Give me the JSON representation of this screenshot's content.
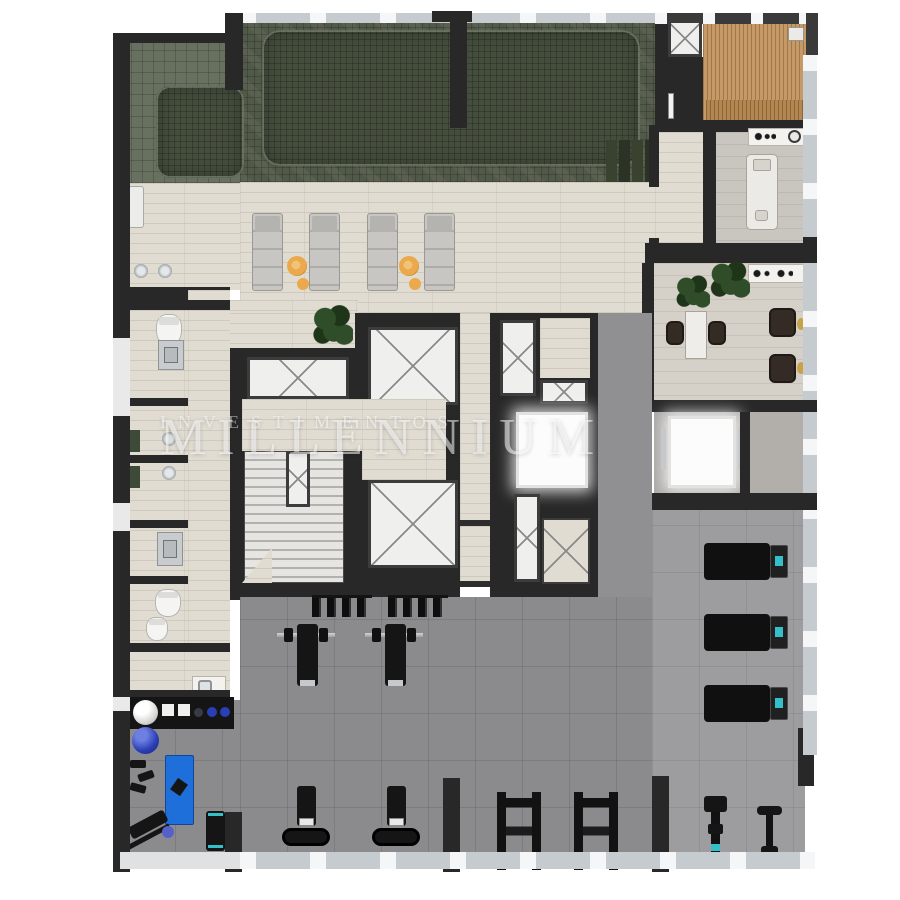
{
  "watermark": {
    "line1": "MILLENNIUM",
    "line2": "INVESTIMENTOS"
  },
  "palette": {
    "wall": "#282828",
    "wall-soft": "#3a3a3a",
    "pool-terrace": "#68705f",
    "pool-base": "#515948",
    "pool-water": "#454e3d",
    "trav": "#e1dcd2",
    "room-floor": "#c9c5bf",
    "gray-corridor": "#909092",
    "gym-floor": "#8b8b8e",
    "gym-floor-light": "#9d9da0",
    "wood": "#c59a66",
    "wood-bench": "#b3874f",
    "glass": "#c6cbcf",
    "glass-tick": "#f4f6f7",
    "white-panel": "#efefed",
    "x-line": "#8a8a8a",
    "bright": "#fcfcfc",
    "lounger": "#c8c6c2",
    "lounger-line": "#aeaca8",
    "towel": "#eaa94d",
    "plant": "#2f4d28",
    "plant-dark": "#1f3519",
    "steel": "#c9ccce",
    "equip": "#151515",
    "teal": "#35c0c9",
    "blue-ball": "#2a3fb5",
    "mat-blue": "#1e6fd9",
    "watermark": "rgba(255,255,255,0.55)"
  },
  "legend": {
    "pool": "mosaic swimming pool",
    "pool-steps": "pool entry steps",
    "sun-lounger": "pool sun lounger",
    "towel-roll": "rolled orange towel",
    "sauna": "wood-lined sauna deck",
    "massage-table": "spa massage table",
    "elevator": "elevator shaft with X mark",
    "stairs": "emergency stairs",
    "treadmill": "treadmill",
    "weight-bench": "bench with barbell",
    "dumbbell-rack": "wall dumbbell rack",
    "squat-rack": "squat rack",
    "rowing-machine": "rowing machine",
    "exercise-bike": "exercise bike",
    "exercise-ball": "exercise ball",
    "yoga-mat": "blue exercise mat",
    "toilet": "toilet",
    "shower": "shower fixture",
    "sink": "sink / vanity",
    "plant": "potted plant",
    "glass-facade": "glazed facade with mullions"
  }
}
